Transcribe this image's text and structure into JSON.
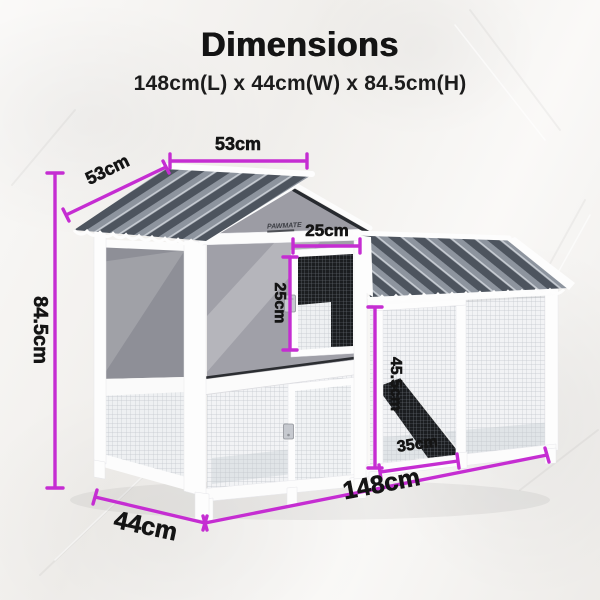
{
  "header": {
    "title": "Dimensions",
    "subtitle": "148cm(L) x 44cm(W) x 84.5cm(H)"
  },
  "brand": {
    "logo_text": "PAWMATE"
  },
  "dimensions": {
    "roof_width": "53cm",
    "roof_depth": "53cm",
    "hatch_width": "25cm",
    "hatch_height": "25cm",
    "total_height": "84.5cm",
    "run_height": "45.5cm",
    "run_door_width": "35cm",
    "total_length": "148cm",
    "total_depth": "44cm"
  },
  "colors": {
    "accent": "#c52dd2",
    "roof_dark": "#4d545e",
    "roof_stripe": "#8d949e",
    "panel_gray": "#9c9ca4",
    "frame_white": "#fdfdfd",
    "background": "#f5f3f0",
    "text": "#141414"
  }
}
